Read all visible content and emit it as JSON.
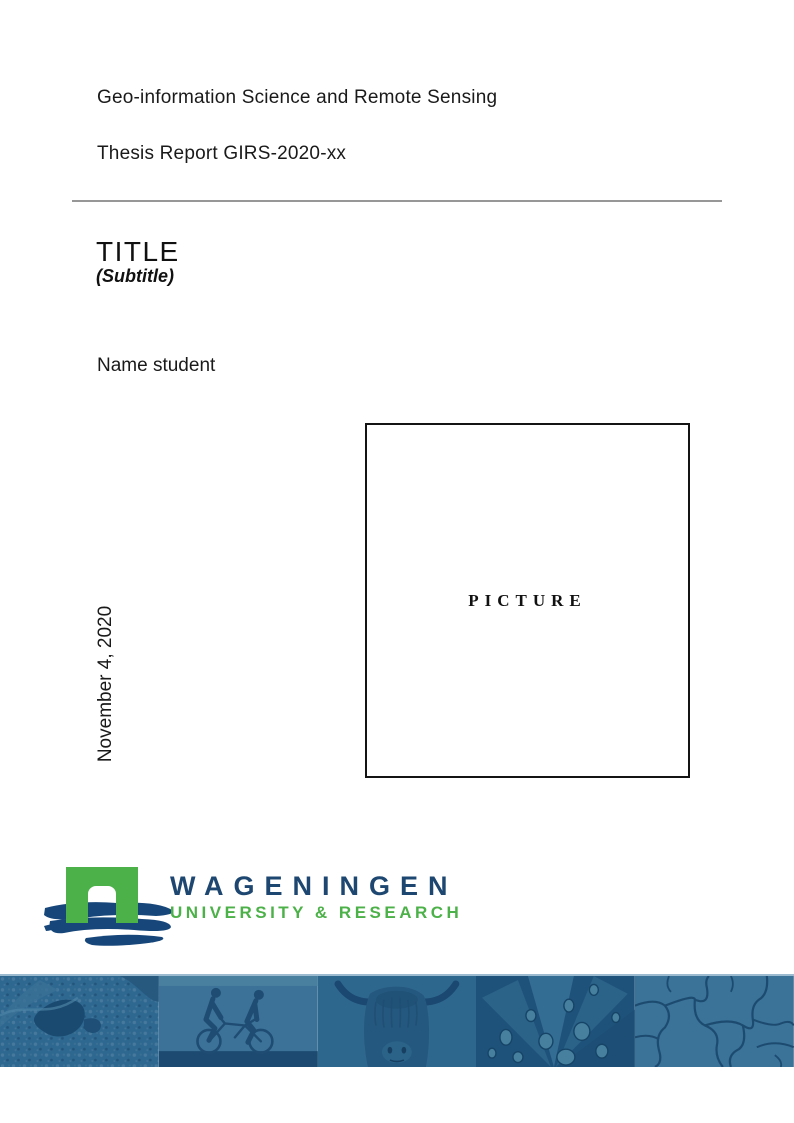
{
  "header": {
    "program": "Geo-information Science and Remote Sensing",
    "report_id": "Thesis Report GIRS-2020-xx"
  },
  "titleblock": {
    "title": "TITLE",
    "subtitle": "(Subtitle)",
    "author": "Name student",
    "date": "November 4, 2020"
  },
  "picture": {
    "placeholder": "PICTURE"
  },
  "logo": {
    "wordmark": "WAGENINGEN",
    "tagline": "UNIVERSITY & RESEARCH",
    "colors": {
      "brand_blue": "#1D4770",
      "brand_green": "#4CB148"
    }
  },
  "banner": {
    "tint_base": "#2E6890",
    "tint_dark": "#1C4A70",
    "images": [
      {
        "label": "aerial-map"
      },
      {
        "label": "tandem-cyclists"
      },
      {
        "label": "highland-cow"
      },
      {
        "label": "leaf-water-droplets"
      },
      {
        "label": "cracked-earth"
      }
    ]
  }
}
